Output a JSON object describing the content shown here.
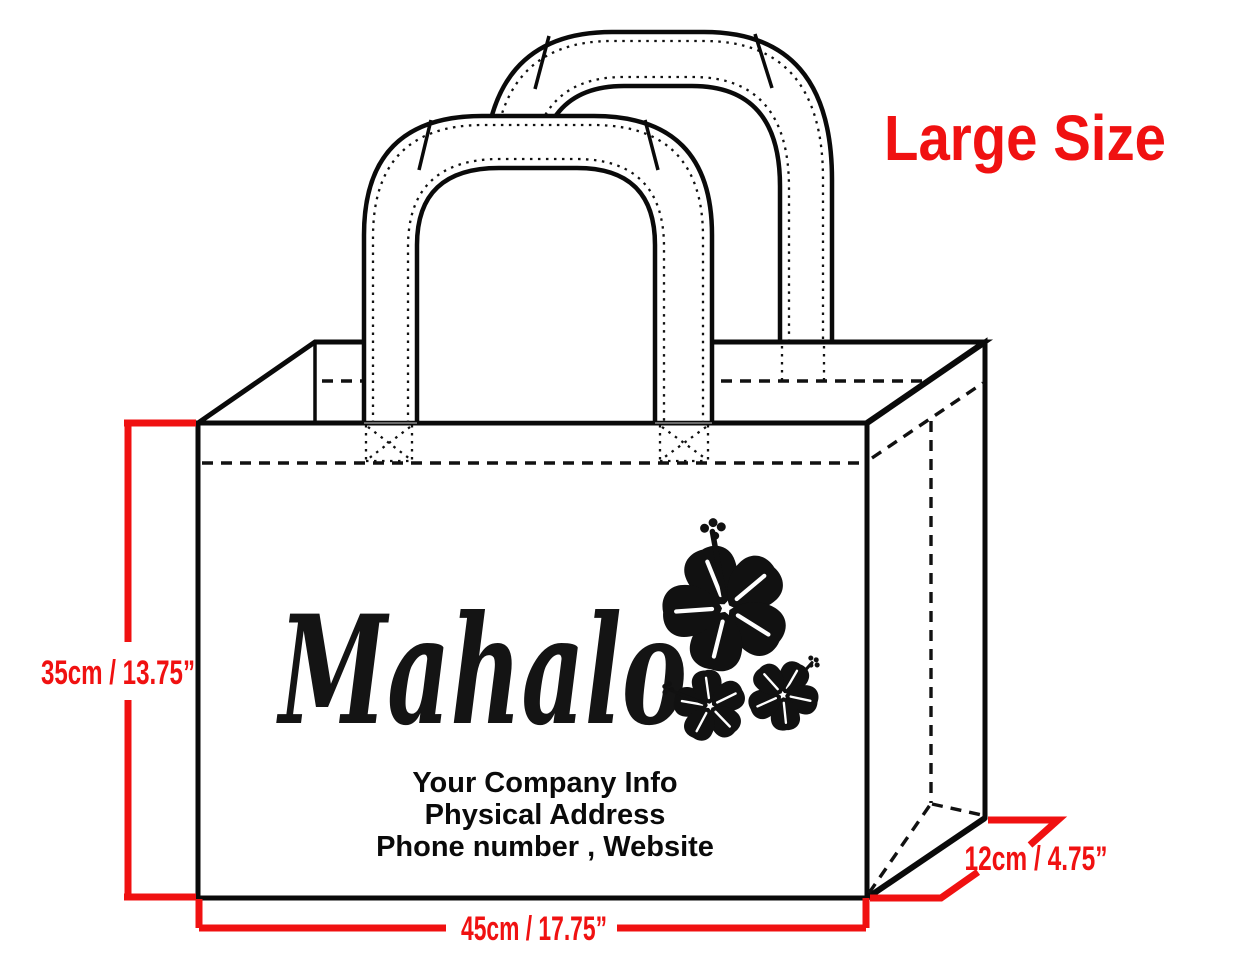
{
  "size_label": {
    "text": "Large Size",
    "color": "#f01111"
  },
  "bag_print": {
    "brand_script": "Mahalo",
    "company_info_lines": [
      "Your Company Info",
      "Physical Address",
      "Phone number , Website"
    ],
    "motif": "hibiscus-flower-cluster"
  },
  "dimension_labels": {
    "height": "35cm / 13.75”",
    "width": "45cm / 17.75”",
    "depth": "12cm / 4.75”",
    "color": "#f01111"
  },
  "drawing": {
    "subject": "tote-bag-technical-sketch",
    "line_color": "#0a0a0a",
    "background": "#ffffff"
  }
}
